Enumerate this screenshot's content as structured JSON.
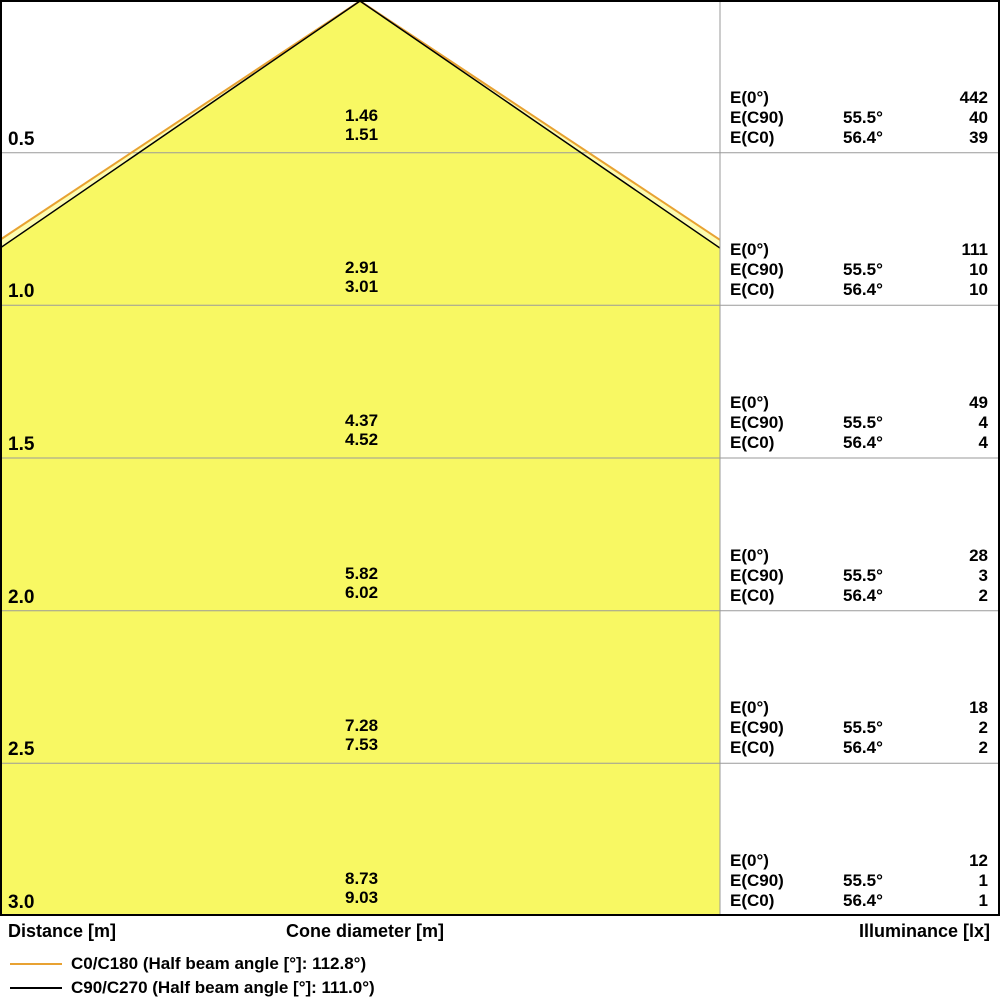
{
  "chart_data": {
    "type": "area",
    "description": "Luminous cone diagram: cone diameter and illuminance vs distance",
    "distances_m": [
      0.5,
      1.0,
      1.5,
      2.0,
      2.5,
      3.0
    ],
    "series": [
      {
        "name": "C0/C180",
        "half_beam_angle_deg": 112.8,
        "half_angle_deg": 56.4,
        "color": "#E8A232",
        "cone_diameters_m": [
          1.51,
          3.01,
          4.52,
          6.02,
          7.53,
          9.03
        ],
        "illuminance_lx": [
          39,
          10,
          4,
          2,
          2,
          1
        ]
      },
      {
        "name": "C90/C270",
        "half_beam_angle_deg": 111.0,
        "half_angle_deg": 55.5,
        "color": "#000000",
        "cone_diameters_m": [
          1.46,
          2.91,
          4.37,
          5.82,
          7.28,
          8.73
        ],
        "illuminance_lx": [
          40,
          10,
          4,
          3,
          2,
          1
        ]
      }
    ],
    "illuminance_e0_lx": [
      442,
      111,
      49,
      28,
      18,
      12
    ],
    "xlabel": "Distance [m]",
    "ylabel_center": "Cone diameter [m]",
    "ylabel_right": "Illuminance [lx]",
    "legend_position": "bottom-left",
    "grid": true,
    "fill_color": "#F8F863",
    "fill_color_outer": "#FDFDB0"
  },
  "rows": [
    {
      "distance": "0.5",
      "cone_c90": "1.46",
      "cone_c0": "1.51",
      "e0": "442",
      "ang_c90": "55.5°",
      "ec90": "40",
      "ang_c0": "56.4°",
      "ec0": "39"
    },
    {
      "distance": "1.0",
      "cone_c90": "2.91",
      "cone_c0": "3.01",
      "e0": "111",
      "ang_c90": "55.5°",
      "ec90": "10",
      "ang_c0": "56.4°",
      "ec0": "10"
    },
    {
      "distance": "1.5",
      "cone_c90": "4.37",
      "cone_c0": "4.52",
      "e0": "49",
      "ang_c90": "55.5°",
      "ec90": "4",
      "ang_c0": "56.4°",
      "ec0": "4"
    },
    {
      "distance": "2.0",
      "cone_c90": "5.82",
      "cone_c0": "6.02",
      "e0": "28",
      "ang_c90": "55.5°",
      "ec90": "3",
      "ang_c0": "56.4°",
      "ec0": "2"
    },
    {
      "distance": "2.5",
      "cone_c90": "7.28",
      "cone_c0": "7.53",
      "e0": "18",
      "ang_c90": "55.5°",
      "ec90": "2",
      "ang_c0": "56.4°",
      "ec0": "2"
    },
    {
      "distance": "3.0",
      "cone_c90": "8.73",
      "cone_c0": "9.03",
      "e0": "12",
      "ang_c90": "55.5°",
      "ec90": "1",
      "ang_c0": "56.4°",
      "ec0": "1"
    }
  ],
  "illum_labels": {
    "e0": "E(0°)",
    "ec90": "E(C90)",
    "ec0": "E(C0)"
  },
  "axis": {
    "distance": "Distance [m]",
    "cone": "Cone diameter [m]",
    "illuminance": "Illuminance [lx]"
  },
  "legend": [
    {
      "label": "C0/C180 (Half beam angle [°]: 112.8°)",
      "color": "#E8A232"
    },
    {
      "label": "C90/C270 (Half beam angle [°]: 111.0°)",
      "color": "#000000"
    }
  ]
}
